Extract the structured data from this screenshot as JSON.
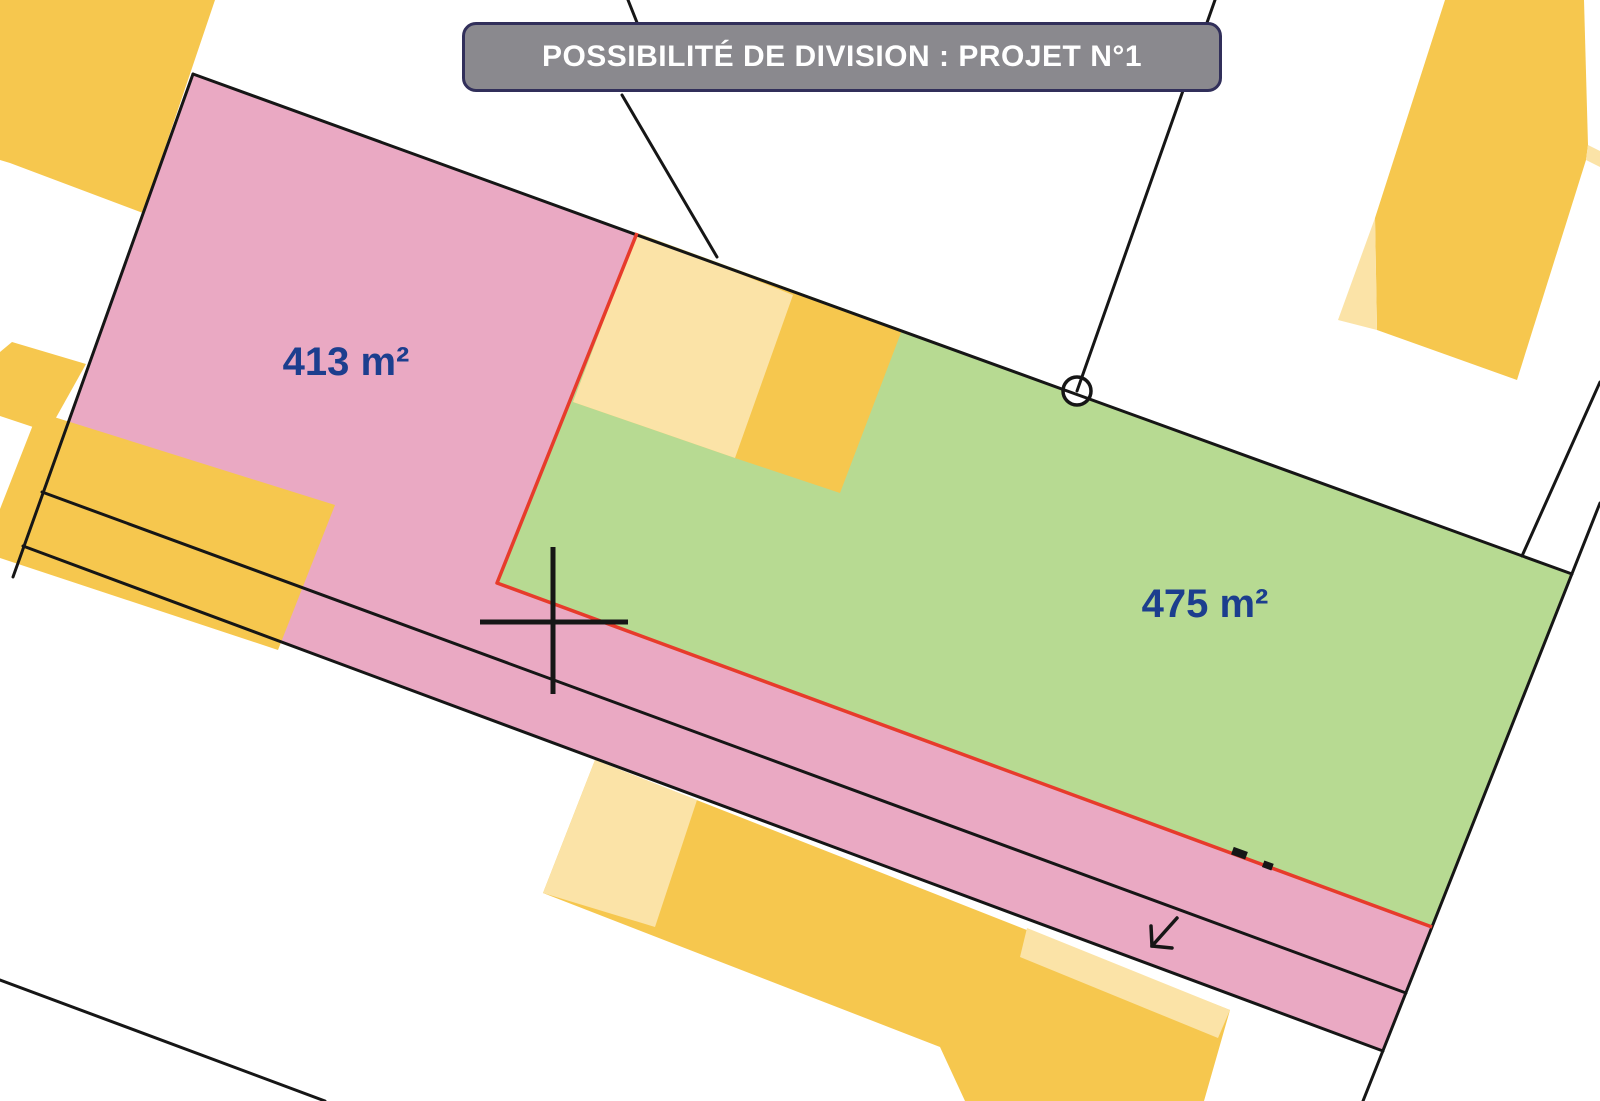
{
  "banner": {
    "title": "POSSIBILITÉ DE DIVISION : PROJET N°1"
  },
  "lots": [
    {
      "name": "Lot 1",
      "area_label": "413 m²"
    },
    {
      "name": "Lot 2",
      "area_label": "475 m²"
    }
  ],
  "colors": {
    "lot1_pink": "#eaa9c3",
    "lot2_green": "#b7da92",
    "building_dark_yellow": "#f6c74e",
    "building_light_yellow": "#fbe3a7",
    "division_line_red": "#e73b2b",
    "boundary_black": "#161616",
    "banner_bg": "#8a898e",
    "banner_border": "#312f5a",
    "area_text_navy": "#1c3e8e",
    "marker_circle_fill": "#ffffff"
  }
}
